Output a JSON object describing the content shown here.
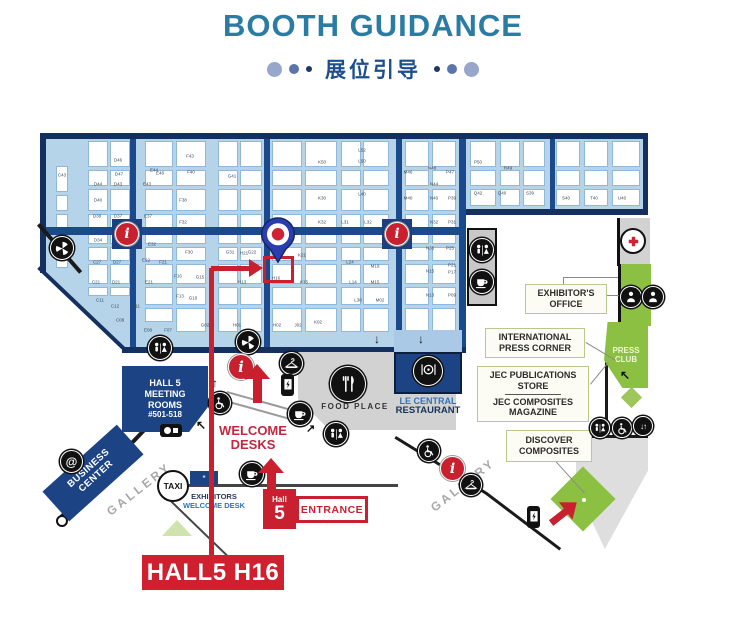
{
  "header": {
    "title": "BOOTH GUIDANCE",
    "subtitle_cn": "展位引导"
  },
  "target": {
    "label": "HALL5 H16",
    "booth": "H16",
    "hall": "Hall 5"
  },
  "map": {
    "callouts": {
      "exhibitors_office": {
        "lines": [
          "EXHIBITOR'S",
          "OFFICE"
        ]
      },
      "international_press": {
        "lines": [
          "INTERNATIONAL",
          "PRESS CORNER"
        ]
      },
      "jec_store": {
        "lines": [
          "JEC PUBLICATIONS",
          "STORE"
        ]
      },
      "jec_magazine": {
        "lines": [
          "JEC COMPOSITES",
          "MAGAZINE"
        ]
      },
      "discover": {
        "lines": [
          "DISCOVER",
          "COMPOSITES"
        ]
      }
    },
    "zones": {
      "press_club": {
        "lines": [
          "PRESS",
          "CLUB"
        ]
      },
      "meeting_rooms": {
        "lines": [
          "HALL 5",
          "MEETING",
          "ROOMS",
          "#501-518"
        ]
      },
      "business_center": {
        "lines": [
          "BUSINESS",
          "CENTER"
        ]
      },
      "food_place": {
        "label": "FOOD PLACE"
      },
      "restaurant": {
        "lines": [
          "LE CENTRAL",
          "RESTAURANT"
        ]
      },
      "welcome_desks": {
        "lines": [
          "WELCOME",
          "DESKS"
        ]
      },
      "exhibitors_desk": {
        "lines": [
          "EXHIBITORS",
          "WELCOME DESK"
        ]
      },
      "gallery": {
        "label": "GALLERY"
      },
      "taxi": {
        "label": "TAXI"
      },
      "entrance": {
        "hall": "Hall",
        "num": "5",
        "label": "ENTRANCE"
      }
    },
    "icon_glyphs": {
      "info": "i",
      "at_sign": "@",
      "star": "*",
      "arrow_up": "↑",
      "arrow_down": "↓",
      "arrow_up_left": "↖",
      "arrow_up_right": "↗",
      "elevator": "↓↑"
    },
    "colors": {
      "accent_red": "#c9202f",
      "navy": "#1c4485",
      "hall_blue": "#b5d3e9",
      "green": "#8cc043",
      "title_teal": "#2b7ca3"
    },
    "grid": {
      "columns": [
        {
          "x": 56,
          "w": 12,
          "y0": 166,
          "y1": 268
        },
        {
          "x": 88,
          "w": 20,
          "y0": 141,
          "y1": 296
        },
        {
          "x": 110,
          "w": 20,
          "y0": 141,
          "y1": 296
        },
        {
          "x": 145,
          "w": 28,
          "y0": 141,
          "y1": 322
        },
        {
          "x": 176,
          "w": 30,
          "y0": 141,
          "y1": 334
        },
        {
          "x": 218,
          "w": 20,
          "y0": 141,
          "y1": 338
        },
        {
          "x": 240,
          "w": 22,
          "y0": 141,
          "y1": 338
        },
        {
          "x": 272,
          "w": 30,
          "y0": 141,
          "y1": 338
        },
        {
          "x": 305,
          "w": 32,
          "y0": 141,
          "y1": 338
        },
        {
          "x": 341,
          "w": 20,
          "y0": 141,
          "y1": 338
        },
        {
          "x": 363,
          "w": 26,
          "y0": 141,
          "y1": 338
        },
        {
          "x": 405,
          "w": 24,
          "y0": 141,
          "y1": 332
        },
        {
          "x": 432,
          "w": 24,
          "y0": 141,
          "y1": 332
        },
        {
          "x": 470,
          "w": 26,
          "y0": 141,
          "y1": 206
        },
        {
          "x": 500,
          "w": 20,
          "y0": 141,
          "y1": 206
        },
        {
          "x": 523,
          "w": 22,
          "y0": 141,
          "y1": 206
        },
        {
          "x": 556,
          "w": 24,
          "y0": 141,
          "y1": 206
        },
        {
          "x": 584,
          "w": 24,
          "y0": 141,
          "y1": 206
        },
        {
          "x": 612,
          "w": 28,
          "y0": 141,
          "y1": 206
        }
      ]
    },
    "booths": [
      {
        "t": "C43",
        "x": 62,
        "y": 175
      },
      {
        "t": "D46",
        "x": 118,
        "y": 160
      },
      {
        "t": "D47",
        "x": 119,
        "y": 174
      },
      {
        "t": "D44",
        "x": 98,
        "y": 184
      },
      {
        "t": "D43",
        "x": 118,
        "y": 184
      },
      {
        "t": "E44",
        "x": 154,
        "y": 170
      },
      {
        "t": "E43",
        "x": 147,
        "y": 184
      },
      {
        "t": "E48",
        "x": 160,
        "y": 173
      },
      {
        "t": "F43",
        "x": 190,
        "y": 156
      },
      {
        "t": "F40",
        "x": 191,
        "y": 172
      },
      {
        "t": "G41",
        "x": 232,
        "y": 176
      },
      {
        "t": "D40",
        "x": 98,
        "y": 200
      },
      {
        "t": "D38",
        "x": 97,
        "y": 216
      },
      {
        "t": "D37",
        "x": 118,
        "y": 216
      },
      {
        "t": "E37",
        "x": 148,
        "y": 216
      },
      {
        "t": "F38",
        "x": 183,
        "y": 200
      },
      {
        "t": "F32",
        "x": 183,
        "y": 222
      },
      {
        "t": "K50",
        "x": 322,
        "y": 162
      },
      {
        "t": "K30",
        "x": 322,
        "y": 198
      },
      {
        "t": "K32",
        "x": 322,
        "y": 222
      },
      {
        "t": "L52",
        "x": 362,
        "y": 150
      },
      {
        "t": "L50",
        "x": 362,
        "y": 161
      },
      {
        "t": "L40",
        "x": 362,
        "y": 194
      },
      {
        "t": "L31",
        "x": 345,
        "y": 222
      },
      {
        "t": "L32",
        "x": 368,
        "y": 222
      },
      {
        "t": "M32",
        "x": 408,
        "y": 222
      },
      {
        "t": "N32",
        "x": 434,
        "y": 222
      },
      {
        "t": "P31",
        "x": 452,
        "y": 222
      },
      {
        "t": "M46",
        "x": 408,
        "y": 172
      },
      {
        "t": "M40",
        "x": 408,
        "y": 198
      },
      {
        "t": "N48",
        "x": 432,
        "y": 168
      },
      {
        "t": "N44",
        "x": 434,
        "y": 184
      },
      {
        "t": "N40",
        "x": 434,
        "y": 198
      },
      {
        "t": "P39",
        "x": 452,
        "y": 198
      },
      {
        "t": "P47",
        "x": 450,
        "y": 172
      },
      {
        "t": "P50",
        "x": 478,
        "y": 162
      },
      {
        "t": "R49",
        "x": 508,
        "y": 168
      },
      {
        "t": "Q42",
        "x": 478,
        "y": 193
      },
      {
        "t": "Q40",
        "x": 502,
        "y": 193
      },
      {
        "t": "S39",
        "x": 530,
        "y": 193
      },
      {
        "t": "S40",
        "x": 566,
        "y": 198
      },
      {
        "t": "T40",
        "x": 594,
        "y": 198
      },
      {
        "t": "U40",
        "x": 622,
        "y": 198
      },
      {
        "t": "D34",
        "x": 98,
        "y": 240
      },
      {
        "t": "D31",
        "x": 119,
        "y": 246
      },
      {
        "t": "E32",
        "x": 152,
        "y": 244
      },
      {
        "t": "F30",
        "x": 189,
        "y": 252
      },
      {
        "t": "G31",
        "x": 230,
        "y": 252
      },
      {
        "t": "G22",
        "x": 252,
        "y": 252
      },
      {
        "t": "K21",
        "x": 302,
        "y": 255
      },
      {
        "t": "H21",
        "x": 244,
        "y": 253
      },
      {
        "t": "C27",
        "x": 97,
        "y": 262
      },
      {
        "t": "D27",
        "x": 117,
        "y": 262
      },
      {
        "t": "C21",
        "x": 96,
        "y": 282
      },
      {
        "t": "D21",
        "x": 116,
        "y": 282
      },
      {
        "t": "E22",
        "x": 146,
        "y": 260
      },
      {
        "t": "F21",
        "x": 163,
        "y": 262
      },
      {
        "t": "E21",
        "x": 149,
        "y": 282
      },
      {
        "t": "F16",
        "x": 178,
        "y": 276
      },
      {
        "t": "G15",
        "x": 200,
        "y": 277
      },
      {
        "t": "H13",
        "x": 242,
        "y": 282
      },
      {
        "t": "K15",
        "x": 304,
        "y": 282
      },
      {
        "t": "H16",
        "x": 276,
        "y": 278
      },
      {
        "t": "L24",
        "x": 350,
        "y": 262
      },
      {
        "t": "M19",
        "x": 375,
        "y": 266
      },
      {
        "t": "L14",
        "x": 353,
        "y": 282
      },
      {
        "t": "M15",
        "x": 375,
        "y": 282
      },
      {
        "t": "N35",
        "x": 430,
        "y": 248
      },
      {
        "t": "P25",
        "x": 450,
        "y": 248
      },
      {
        "t": "P21",
        "x": 452,
        "y": 265
      },
      {
        "t": "P17",
        "x": 452,
        "y": 272
      },
      {
        "t": "N15",
        "x": 430,
        "y": 271
      },
      {
        "t": "N13",
        "x": 430,
        "y": 295
      },
      {
        "t": "P09",
        "x": 452,
        "y": 295
      },
      {
        "t": "C11",
        "x": 100,
        "y": 300
      },
      {
        "t": "C12",
        "x": 115,
        "y": 306
      },
      {
        "t": "B11",
        "x": 136,
        "y": 306
      },
      {
        "t": "C08",
        "x": 120,
        "y": 320
      },
      {
        "t": "E08",
        "x": 148,
        "y": 330
      },
      {
        "t": "F07",
        "x": 168,
        "y": 330
      },
      {
        "t": "G10",
        "x": 193,
        "y": 298
      },
      {
        "t": "F13",
        "x": 180,
        "y": 296
      },
      {
        "t": "G02",
        "x": 205,
        "y": 325
      },
      {
        "t": "H01",
        "x": 237,
        "y": 325
      },
      {
        "t": "H02",
        "x": 277,
        "y": 325
      },
      {
        "t": "J02",
        "x": 298,
        "y": 325
      },
      {
        "t": "K02",
        "x": 318,
        "y": 322
      },
      {
        "t": "L38",
        "x": 358,
        "y": 300
      },
      {
        "t": "M02",
        "x": 380,
        "y": 300
      }
    ]
  }
}
